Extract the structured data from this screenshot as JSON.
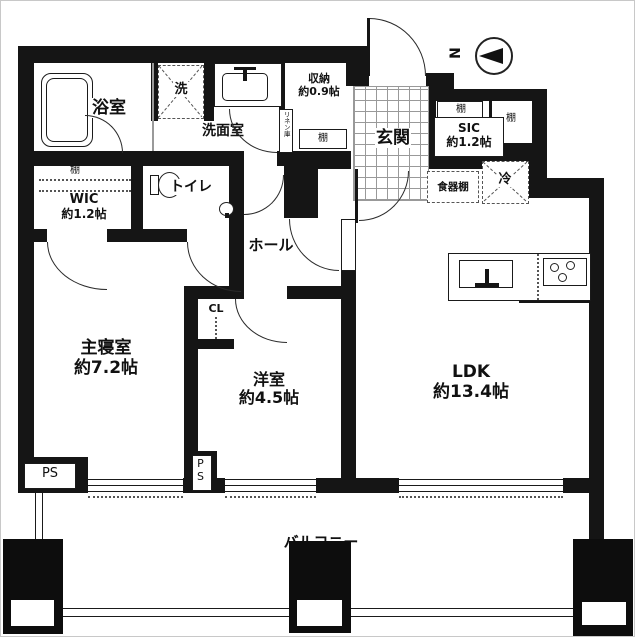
{
  "title": "マンション間取り図",
  "compass": {
    "north_label": "N"
  },
  "rooms": {
    "bath": {
      "name": "浴室"
    },
    "washer": {
      "name": "洗"
    },
    "powder": {
      "name": "洗面室"
    },
    "storage": {
      "name": "収納",
      "size": "約0.9帖"
    },
    "linen": {
      "name": "リネン庫"
    },
    "shelf": {
      "name": "棚"
    },
    "entry": {
      "name": "玄関"
    },
    "sic": {
      "name": "SIC",
      "size": "約1.2帖"
    },
    "cupboard": {
      "name": "食器棚"
    },
    "fridge": {
      "name": "冷"
    },
    "wic": {
      "name": "WIC",
      "size": "約1.2帖"
    },
    "toilet": {
      "name": "トイレ"
    },
    "hall": {
      "name": "ホール"
    },
    "closet": {
      "name": "CL"
    },
    "master": {
      "name": "主寝室",
      "size": "約7.2帖"
    },
    "western": {
      "name": "洋室",
      "size": "約4.5帖"
    },
    "ldk": {
      "name": "LDK",
      "size": "約13.4帖"
    },
    "balcony": {
      "name": "バルコニー"
    },
    "pipe_space": {
      "name": "PS"
    }
  },
  "colors": {
    "wall": "#151515",
    "background": "#ffffff",
    "tile_line": "#999999"
  }
}
